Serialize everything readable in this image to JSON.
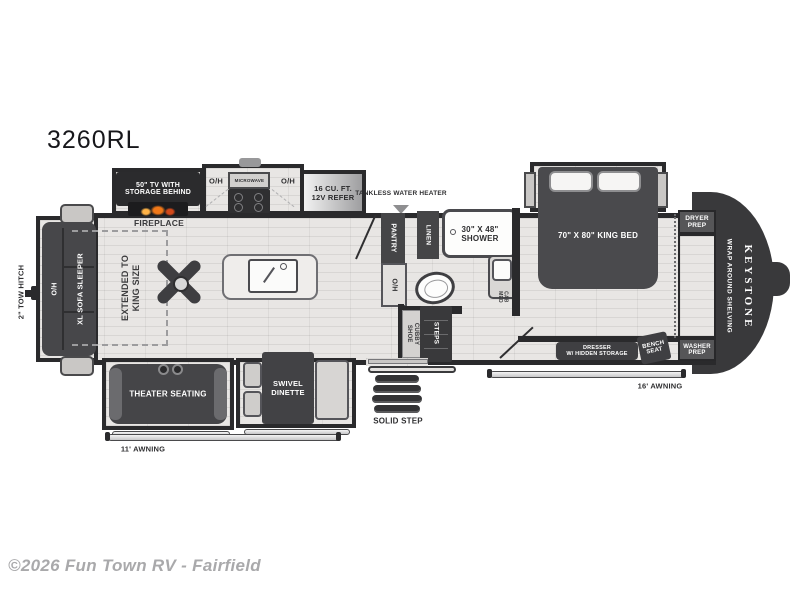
{
  "meta": {
    "model": "3260RL",
    "copyright": "©2026 Fun Town RV - Fairfield"
  },
  "colors": {
    "wall": "#2a2a2c",
    "furniture": "#47474a",
    "floor": "#e8e6e4",
    "flame_accent": "#f07818",
    "watermark": "#a9a9ab",
    "brand_cap": "#39393b"
  },
  "labels": {
    "tow_hitch": "2\" TOW HITCH",
    "sofa_oh": "O/H",
    "sofa": "XL SOFA SLEEPER",
    "extended_1": "EXTENDED TO",
    "extended_2": "KING SIZE",
    "tv_1": "50\" TV WITH",
    "tv_2": "STORAGE BEHIND",
    "fireplace": "FIREPLACE",
    "oh_left": "O/H",
    "microwave": "MICROWAVE",
    "oh_right": "O/H",
    "refer_1": "16 CU. FT.",
    "refer_2": "12V REFER",
    "tankless_1": "TANKLESS",
    "tankless_2": "WATER HEATER",
    "pantry": "PANTRY",
    "counter_oh": "O/H",
    "linen": "LINEN",
    "shower_1": "30\" X 48\"",
    "shower_2": "SHOWER",
    "med_cab_1": "MED",
    "med_cab_2": "CAB",
    "shoe_cubby_1": "SHOE",
    "shoe_cubby_2": "CUBBY",
    "steps": "STEPS",
    "bed_1": "70\" X 80\"",
    "bed_2": "KING BED",
    "dresser_1": "DRESSER",
    "dresser_2": "W/ HIDDEN STORAGE",
    "bench_1": "BENCH",
    "bench_2": "SEAT",
    "dryer_1": "DRYER",
    "dryer_2": "PREP",
    "washer_1": "WASHER",
    "washer_2": "PREP",
    "shelving": "WRAP AROUND SHELVING",
    "brand": "KEYSTONE",
    "theater": "THEATER SEATING",
    "dinette_1": "SWIVEL",
    "dinette_2": "DINETTE",
    "solid_step": "SOLID STEP",
    "awning_left": "11' AWNING",
    "awning_right": "16' AWNING"
  }
}
